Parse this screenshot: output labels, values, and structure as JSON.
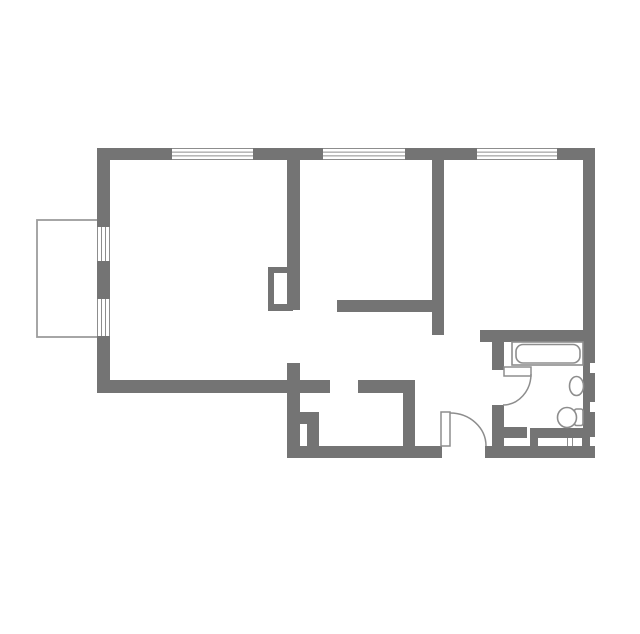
{
  "canvas": {
    "width": 640,
    "height": 634,
    "background": "#ffffff"
  },
  "colors": {
    "wall": "#747474",
    "fixture_line": "#8d8d8d",
    "window_line": "#8d8d8d",
    "balcony_line": "#9c9c9c",
    "floor": "#ffffff"
  },
  "floorplan": {
    "shapes": [
      {
        "type": "rect",
        "name": "balcony-outline",
        "x": 37,
        "y": 220,
        "w": 62,
        "h": 117,
        "fill": "#ffffff",
        "stroke": "#9c9c9c",
        "sw": 1.8
      },
      {
        "type": "rect",
        "name": "wall-top-a",
        "x": 97,
        "y": 148,
        "w": 75,
        "h": 12
      },
      {
        "type": "rect",
        "name": "wall-top-b",
        "x": 253,
        "y": 148,
        "w": 70,
        "h": 12
      },
      {
        "type": "rect",
        "name": "wall-top-c",
        "x": 405,
        "y": 148,
        "w": 72,
        "h": 12
      },
      {
        "type": "rect",
        "name": "wall-top-d",
        "x": 557,
        "y": 148,
        "w": 38,
        "h": 12
      },
      {
        "type": "rect",
        "name": "wall-right",
        "x": 583,
        "y": 148,
        "w": 12,
        "h": 310
      },
      {
        "type": "rect",
        "name": "wall-left-a",
        "x": 97,
        "y": 148,
        "w": 13,
        "h": 79
      },
      {
        "type": "rect",
        "name": "wall-left-b",
        "x": 97,
        "y": 261,
        "w": 13,
        "h": 38
      },
      {
        "type": "rect",
        "name": "wall-left-c",
        "x": 97,
        "y": 336,
        "w": 13,
        "h": 56
      },
      {
        "type": "rect",
        "name": "wall-living-bottom",
        "x": 97,
        "y": 380,
        "w": 233,
        "h": 13
      },
      {
        "type": "rect",
        "name": "wall-entry-left",
        "x": 287,
        "y": 380,
        "w": 13,
        "h": 78
      },
      {
        "type": "rect",
        "name": "wall-bedroom1-left",
        "x": 287,
        "y": 160,
        "w": 13,
        "h": 150
      },
      {
        "type": "rect",
        "name": "wall-bedroom1-door-stub",
        "x": 287,
        "y": 363,
        "w": 13,
        "h": 17
      },
      {
        "type": "rect",
        "name": "wall-bedroom1-bottom",
        "x": 337,
        "y": 300,
        "w": 95,
        "h": 12
      },
      {
        "type": "rect",
        "name": "wall-bedroom2-left",
        "x": 432,
        "y": 160,
        "w": 12,
        "h": 175
      },
      {
        "type": "rect",
        "name": "wall-corridor-top",
        "x": 358,
        "y": 380,
        "w": 57,
        "h": 13
      },
      {
        "type": "rect",
        "name": "wall-hall-west",
        "x": 403,
        "y": 380,
        "w": 12,
        "h": 66
      },
      {
        "type": "rect",
        "name": "wall-bottom-a",
        "x": 287,
        "y": 446,
        "w": 155,
        "h": 12
      },
      {
        "type": "rect",
        "name": "wall-bottom-b",
        "x": 485,
        "y": 446,
        "w": 110,
        "h": 12
      },
      {
        "type": "rect",
        "name": "wall-bathroom-top",
        "x": 480,
        "y": 330,
        "w": 115,
        "h": 12
      },
      {
        "type": "rect",
        "name": "wall-bathroom-left-a",
        "x": 492,
        "y": 342,
        "w": 12,
        "h": 28
      },
      {
        "type": "rect",
        "name": "wall-bathroom-left-b",
        "x": 492,
        "y": 405,
        "w": 12,
        "h": 41
      },
      {
        "type": "rect",
        "name": "wall-bathroom-door-stub",
        "x": 504,
        "y": 427,
        "w": 23,
        "h": 11
      },
      {
        "type": "rect",
        "name": "wall-duct-top",
        "x": 297,
        "y": 412,
        "w": 22,
        "h": 12
      },
      {
        "type": "rect",
        "name": "wall-duct-right",
        "x": 307,
        "y": 412,
        "w": 12,
        "h": 35
      },
      {
        "type": "rect",
        "name": "wall-bathroom-ledge",
        "x": 530,
        "y": 428,
        "w": 65,
        "h": 18
      },
      {
        "type": "rect",
        "name": "ledge-recess",
        "x": 538,
        "y": 438,
        "w": 44,
        "h": 8,
        "fill": "#ffffff"
      },
      {
        "type": "line",
        "name": "ledge-grille-line-1",
        "x1": 567.5,
        "y1": 438,
        "x2": 567.5,
        "y2": 446,
        "stroke": "#8d8d8d",
        "sw": 1
      },
      {
        "type": "line",
        "name": "ledge-grille-line-2",
        "x1": 572.5,
        "y1": 438,
        "x2": 572.5,
        "y2": 446,
        "stroke": "#8d8d8d",
        "sw": 1
      },
      {
        "type": "rect",
        "name": "wall-notch-1",
        "x": 590,
        "y": 363,
        "w": 5,
        "h": 10,
        "fill": "#ffffff"
      },
      {
        "type": "rect",
        "name": "wall-notch-2",
        "x": 590,
        "y": 402,
        "w": 5,
        "h": 10,
        "fill": "#ffffff"
      },
      {
        "type": "rect",
        "name": "wall-notch-3",
        "x": 590,
        "y": 437,
        "w": 5,
        "h": 9,
        "fill": "#ffffff"
      },
      {
        "type": "window",
        "name": "window-top-1",
        "x": 172,
        "y": 148,
        "w": 81,
        "h": 12,
        "dir": "h"
      },
      {
        "type": "window",
        "name": "window-top-2",
        "x": 323,
        "y": 148,
        "w": 82,
        "h": 12,
        "dir": "h"
      },
      {
        "type": "window",
        "name": "window-top-3",
        "x": 477,
        "y": 148,
        "w": 80,
        "h": 12,
        "dir": "h"
      },
      {
        "type": "window",
        "name": "window-left-1",
        "x": 97,
        "y": 227,
        "w": 13,
        "h": 34,
        "dir": "v"
      },
      {
        "type": "window",
        "name": "window-left-2",
        "x": 97,
        "y": 299,
        "w": 13,
        "h": 37,
        "dir": "v"
      },
      {
        "type": "rect",
        "name": "bedroom1-door-frame",
        "x": 268,
        "y": 267,
        "w": 25,
        "h": 44
      },
      {
        "type": "rect",
        "name": "bedroom1-door-frame-inner",
        "x": 274,
        "y": 273,
        "w": 13,
        "h": 31,
        "fill": "#ffffff"
      },
      {
        "type": "rect",
        "name": "bathtub-outer",
        "x": 512,
        "y": 342,
        "w": 71,
        "h": 23,
        "fill": "#ffffff",
        "stroke": "#8d8d8d",
        "sw": 1.6
      },
      {
        "type": "rect",
        "name": "bathtub-inner",
        "x": 516,
        "y": 344.5,
        "w": 64,
        "h": 18.5,
        "rx": 7,
        "fill": "#ffffff",
        "stroke": "#8d8d8d",
        "sw": 1.6
      },
      {
        "type": "ellipse",
        "name": "sink-basin",
        "cx": 576.5,
        "cy": 386,
        "rx": 7,
        "ry": 9.5,
        "fill": "#ffffff",
        "stroke": "#8d8d8d",
        "sw": 1.6
      },
      {
        "type": "rect",
        "name": "toilet-tank",
        "x": 574.5,
        "y": 409,
        "w": 8.5,
        "h": 16.5,
        "rx": 2,
        "fill": "#ffffff",
        "stroke": "#8d8d8d",
        "sw": 1.6
      },
      {
        "type": "ellipse",
        "name": "toilet-bowl",
        "cx": 567,
        "cy": 417.5,
        "rx": 9.5,
        "ry": 10,
        "fill": "#ffffff",
        "stroke": "#8d8d8d",
        "sw": 1.6
      },
      {
        "type": "rect",
        "name": "entry-door-leaf",
        "x": 441,
        "y": 412,
        "w": 9,
        "h": 34,
        "fill": "#ffffff",
        "stroke": "#8d8d8d",
        "sw": 1.5
      },
      {
        "type": "path",
        "name": "entry-door-arc",
        "d": "M 450 413 A 36 33 0 0 1 486 446",
        "stroke": "#8d8d8d",
        "sw": 1.5
      },
      {
        "type": "rect",
        "name": "bathroom-door-leaf",
        "x": 504,
        "y": 367,
        "w": 27,
        "h": 9,
        "fill": "#ffffff",
        "stroke": "#8d8d8d",
        "sw": 1.5
      },
      {
        "type": "path",
        "name": "bathroom-door-arc",
        "d": "M 531 374 A 28 31 0 0 1 503 405",
        "stroke": "#8d8d8d",
        "sw": 1.5
      }
    ]
  }
}
